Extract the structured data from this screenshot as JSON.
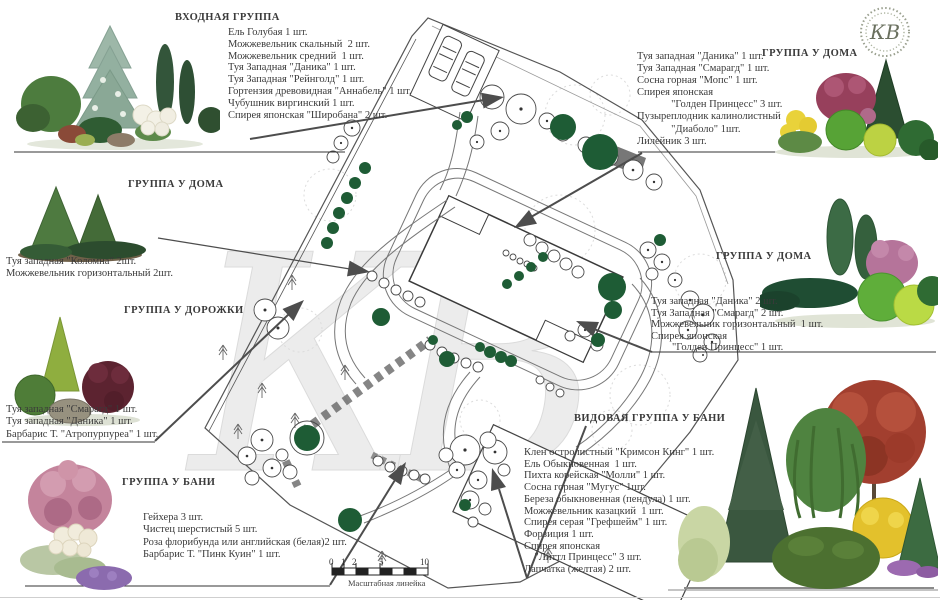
{
  "logo": {
    "monogram": "КВ"
  },
  "watermark": "КВ",
  "scale_bar": {
    "label": "Масштабная линейка",
    "ticks": [
      "0",
      "1",
      "2",
      "5",
      "10"
    ]
  },
  "groups": [
    {
      "title": "ВХОДНАЯ ГРУППА",
      "items": [
        "Ель Голубая 1 шт.",
        "Можжевельник скальный  2 шт.",
        "Можжевельник средний  1 шт.",
        "Туя Западная \"Даника\" 1 шт.",
        "Туя Западная \"Рейнголд\" 1 шт.",
        "Гортензия древовидная \"Аннабель\" 1 шт.",
        "Чубушник виргинский 1 шт.",
        "Спирея японская \"Широбана\" 2 шт."
      ]
    },
    {
      "title": "ГРУППА У ДОМА",
      "items": [
        "Туя западная \"Даника\" 1 шт.",
        "Туя Западная \"Смарагд\" 1 шт.",
        "Сосна горная \"Мопс\" 1 шт.",
        "Спирея японская",
        "             \"Голден Принцесс\" 3 шт.",
        "Пузыреплодник калинолистный",
        "             \"Диаболо\" 1шт.",
        "Лилейник 3 шт."
      ]
    },
    {
      "title": "ГРУППА У ДОМА",
      "items": [
        "Туя западная \"Коломна\" 2шт.",
        "Можжевельник горизонтальный 2шт."
      ]
    },
    {
      "title": "ГРУППА У ДОРОЖКИ",
      "items": [
        "Туя западная \"Смарагд\" 1 шт.",
        "Туя западная \"Даника\" 1 шт.",
        "Барбарис Т. \"Атропурпуреа\" 1 шт."
      ]
    },
    {
      "title": "ГРУППА  У  БАНИ",
      "items": [
        "Гейхера 3 шт.",
        "Чистец шерстистый 5 шт.",
        "Роза флорибунда или английская (белая)2 шт.",
        "Барбарис Т. \"Пинк Куин\" 1 шт."
      ]
    },
    {
      "title": "ГРУППА У ДОМА",
      "items": [
        "Туя западная \"Даника\" 2 шт.",
        "Туя Западная \"Смарагд\" 2 шт.",
        "Можжевельник горизонтальный  1 шт.",
        "Спирея японская",
        "        \"Голден Принцесс\" 1 шт."
      ]
    },
    {
      "title": "ВИДОВАЯ  ГРУППА  У  БАНИ",
      "items": [
        "Клен остролистный \"Кримсон Кинг\" 1 шт.",
        "Ель Обыкновенная  1 шт.",
        "Пихта корейская \"Молли\" 1 шт.",
        "Сосна горная \"Мугус\" 1шт.",
        "Береза обыкновенная (пендула) 1 шт.",
        "Можжевельник казацкий  1 шт.",
        "Спирея серая \"Грефшейм\" 1 шт.",
        "Форзиция 1 шт.",
        "Спирея японская",
        "    \"Литтл Принцесс\" 3 шт.",
        "Лапчатка (желтая) 2 шт."
      ]
    }
  ]
}
